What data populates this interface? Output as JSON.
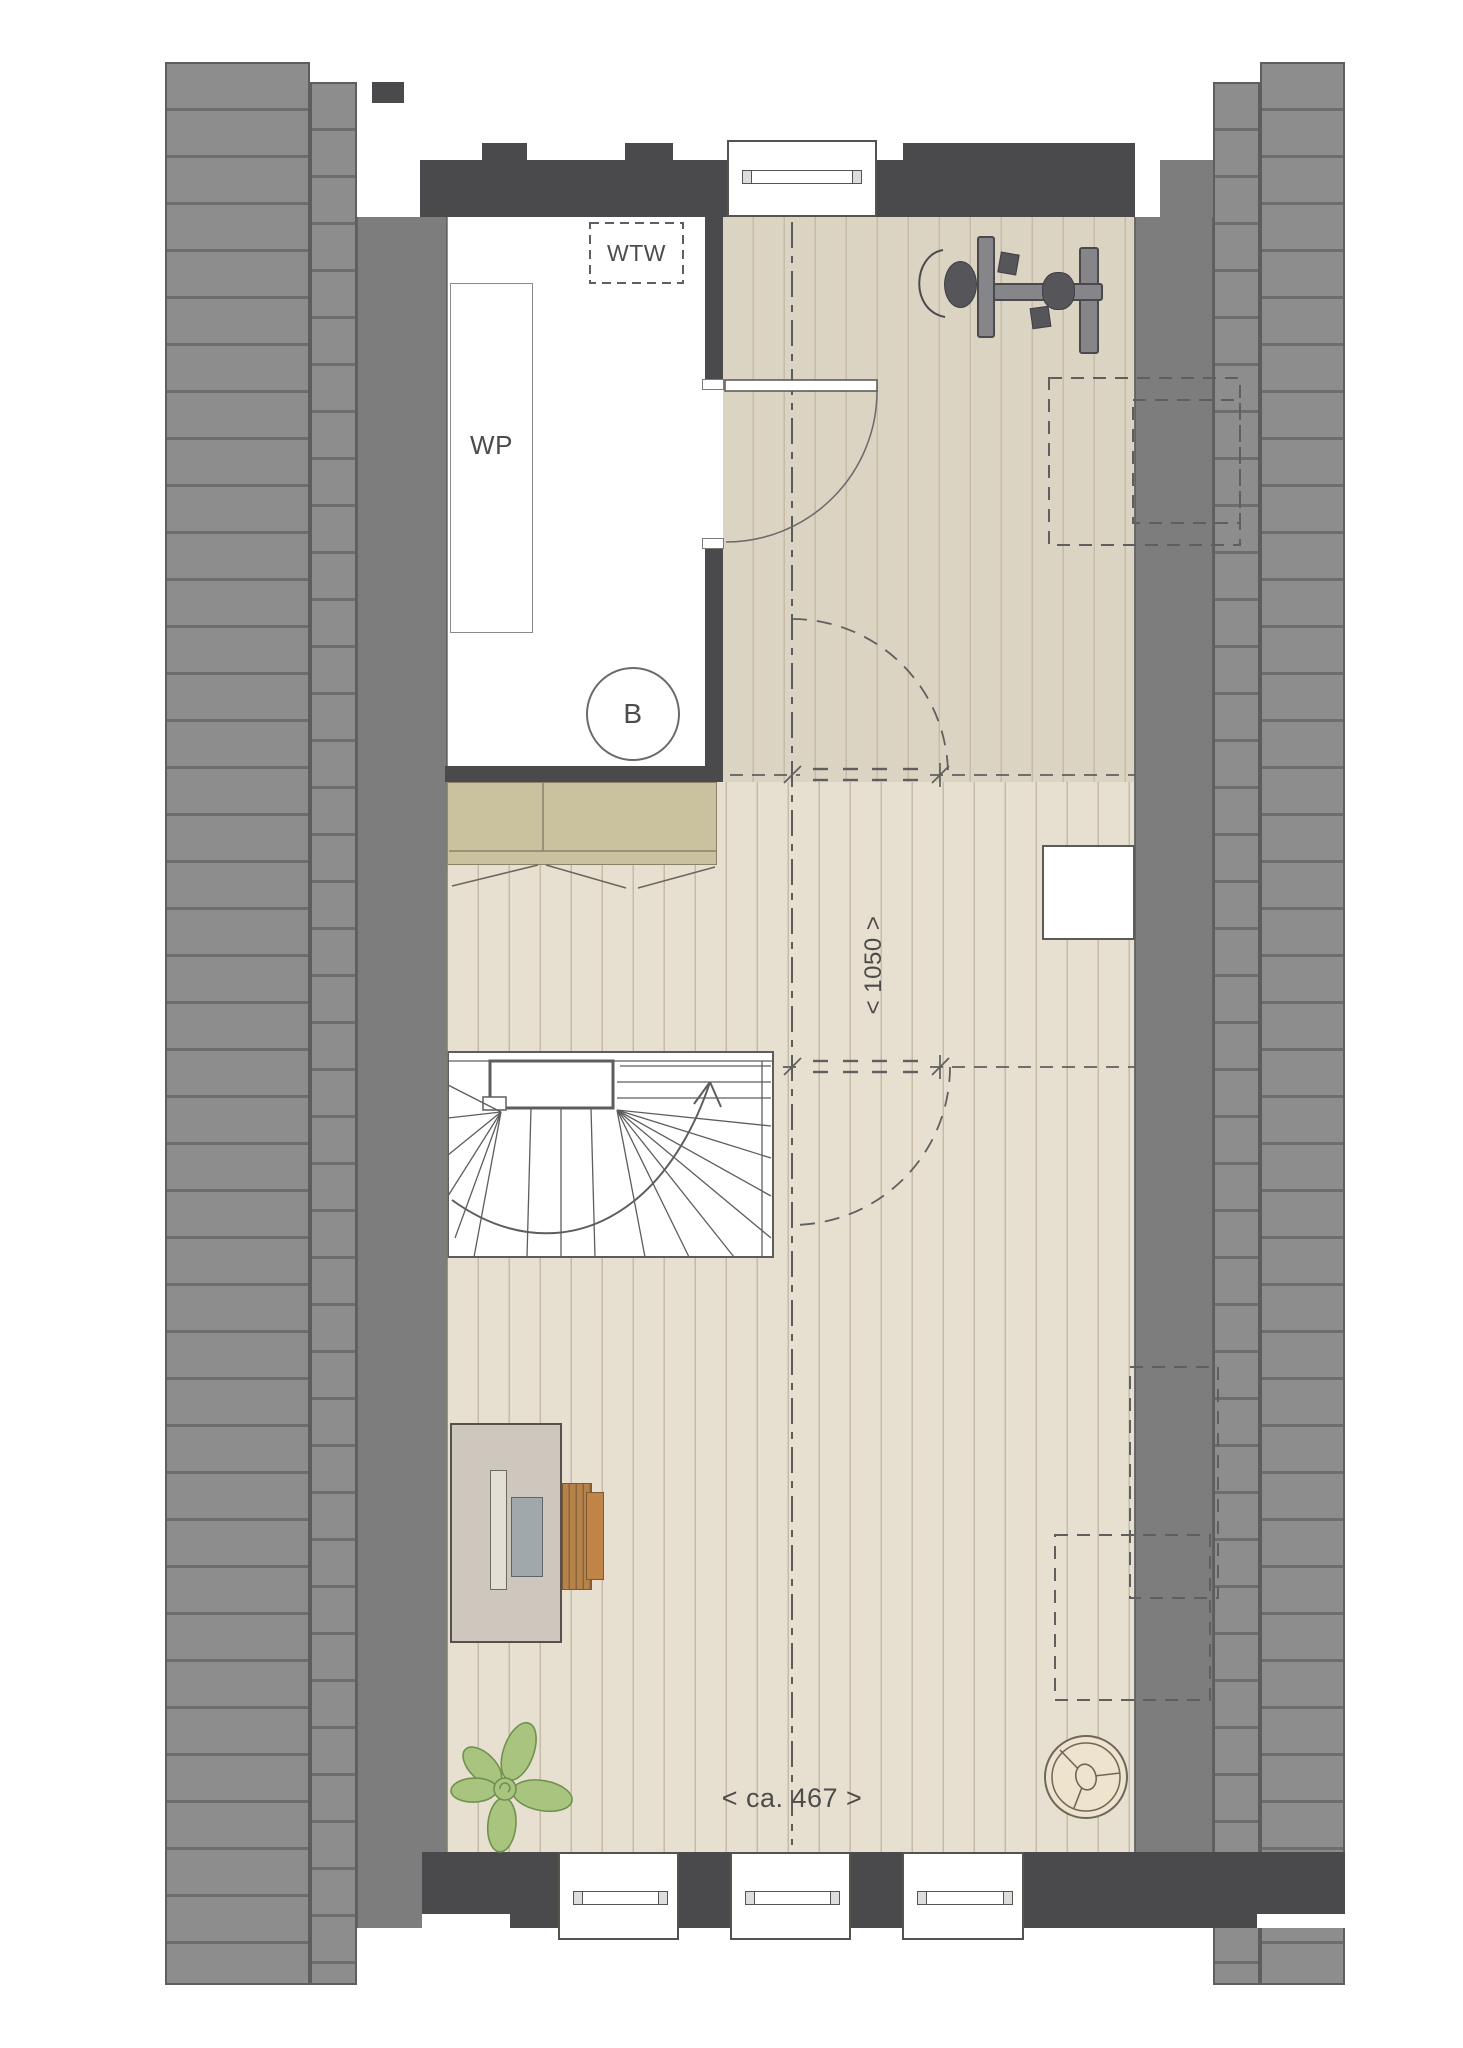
{
  "plan": {
    "labels": {
      "heat_recovery_unit": "WTW",
      "heat_pump": "WP",
      "boiler": "B",
      "headroom_depth_dim": "< 1050 >",
      "room_width_dim": "< ca. 467 >"
    },
    "colors": {
      "wall_dark": "#4a4a4c",
      "roof": "#8d8d8d",
      "roof_line": "#6d6d6d",
      "band": "#7d7d7d",
      "floor_upper": "#dcd4c3",
      "floor_lower": "#e7e0d1",
      "floor_line": "#c6bba8",
      "closet": "#cac19f",
      "closet_line": "#8a8269",
      "desk": "#cec7be",
      "desk_inner": "#e4ded4",
      "screen": "#9fa8ab",
      "chair": "#b5824a",
      "chair_dark": "#8a6338",
      "plant": "#a9c47f",
      "plant_line": "#71914e",
      "equip": "#85858a",
      "equip_dark": "#55555a",
      "fan_fill": "#eee3cd",
      "line": "#5c5c5c",
      "text": "#4c4c4c"
    }
  }
}
